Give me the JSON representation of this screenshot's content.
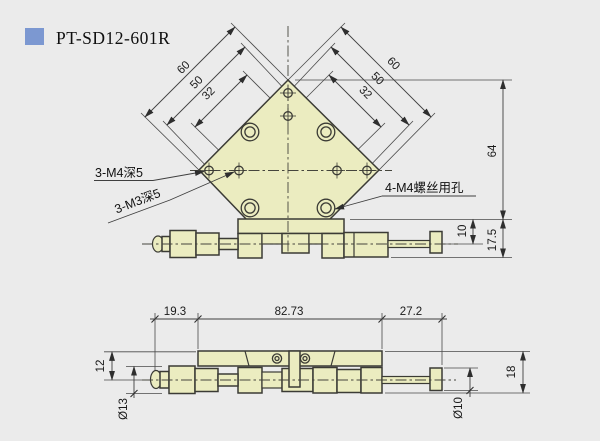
{
  "header": {
    "title": "PT-SD12-601R"
  },
  "colors": {
    "background": "#ebebeb",
    "part_fill": "#ebecc0",
    "line": "#3b3b35",
    "title_bullet": "#7c98d1"
  },
  "top_view": {
    "dims": {
      "left_outer": "60",
      "left_mid": "50",
      "left_inner": "32",
      "right_outer": "60",
      "right_mid": "50",
      "right_inner": "32",
      "height": "64",
      "rod_offset": "10",
      "base_height": "17.5"
    },
    "labels": {
      "m4_tapped": "3-M4深5",
      "m3_tapped": "3-M3深5",
      "screw_holes": "4-M4螺丝用孔"
    }
  },
  "side_view": {
    "dims": {
      "left": "19.3",
      "middle": "82.73",
      "right": "27.2",
      "plate_to_axis": "12",
      "dia_left": "Ø13",
      "height": "18",
      "dia_right": "Ø10"
    }
  }
}
